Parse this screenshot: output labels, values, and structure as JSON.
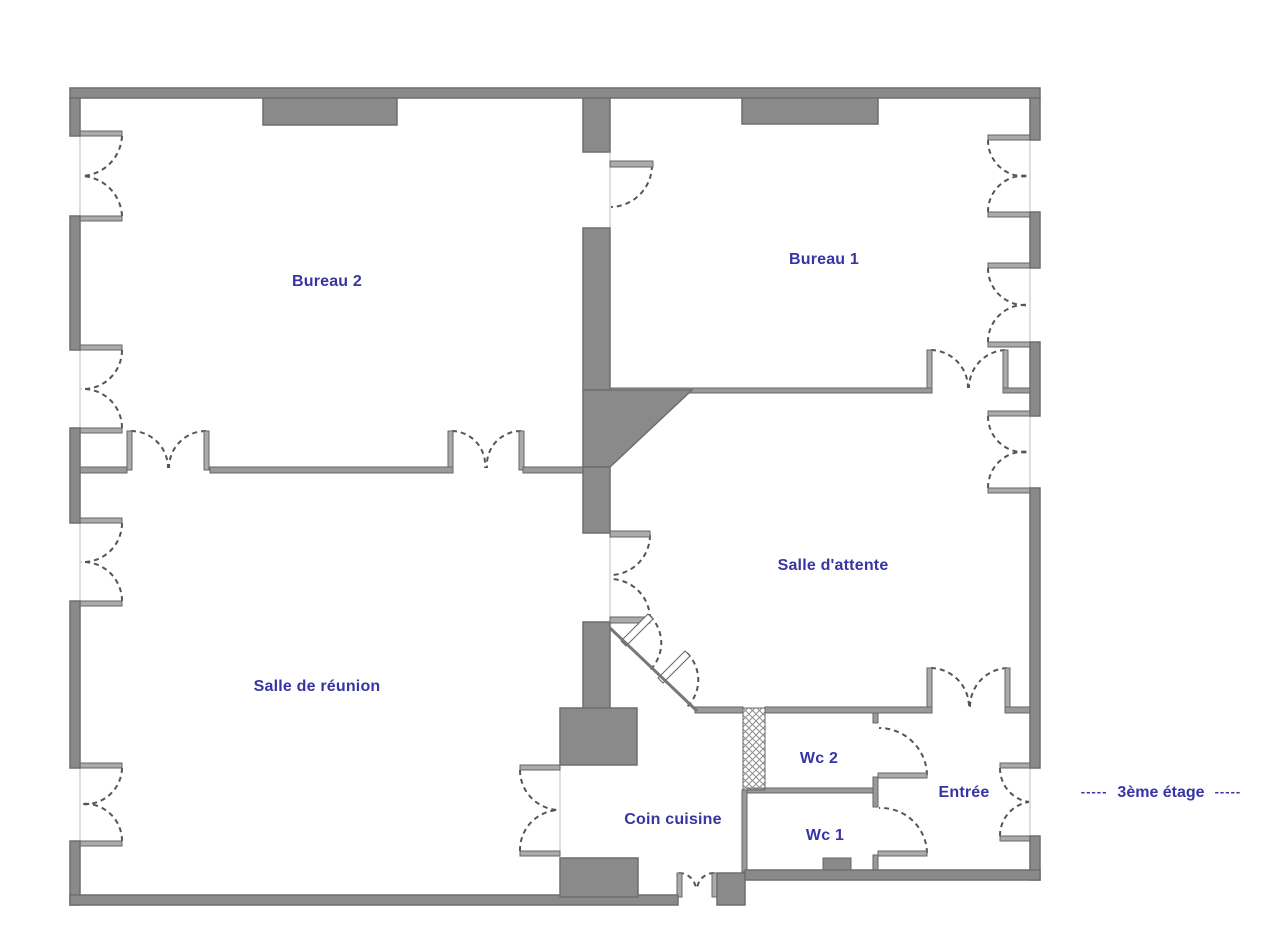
{
  "plan": {
    "floor": {
      "dashes": "-----",
      "label": "3ème étage"
    },
    "rooms": [
      {
        "id": "bureau-2",
        "label": "Bureau 2"
      },
      {
        "id": "bureau-1",
        "label": "Bureau 1"
      },
      {
        "id": "salle-attente",
        "label": "Salle d'attente"
      },
      {
        "id": "salle-reunion",
        "label": "Salle de réunion"
      },
      {
        "id": "coin-cuisine",
        "label": "Coin cuisine"
      },
      {
        "id": "wc-2",
        "label": "Wc 2"
      },
      {
        "id": "wc-1",
        "label": "Wc 1"
      },
      {
        "id": "entree",
        "label": "Entrée"
      }
    ],
    "colors": {
      "wall_fill": "#8a8a8a",
      "wall_outline": "#6e6e6e",
      "thin_wall": "#9a9a9a",
      "door_arc": "#555555",
      "label_blue": "#3834a3",
      "background": "#ffffff"
    },
    "features": [
      "casement-window-icon",
      "double-door-icon",
      "single-door-icon",
      "hatched-duct-icon",
      "chimney-block-icon",
      "angled-wall",
      "entry-double-door-icon"
    ]
  }
}
